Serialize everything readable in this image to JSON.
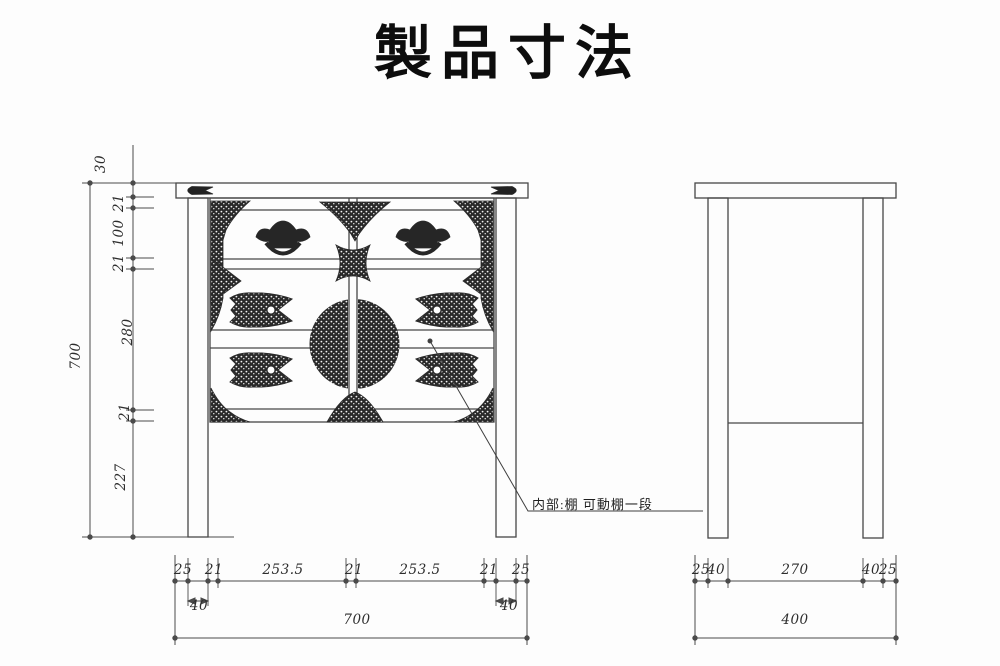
{
  "title": "製品寸法",
  "annotation": {
    "text": "内部:棚  可動棚一段"
  },
  "dimensions": {
    "front_view": {
      "height_chain_mm": [
        "30",
        "21",
        "100",
        "21",
        "280",
        "21",
        "227"
      ],
      "height_total_mm": "700",
      "width_chain_mm": [
        "25",
        "21",
        "253.5",
        "21",
        "253.5",
        "21",
        "25"
      ],
      "leg_width_mm": [
        "40",
        "40"
      ],
      "width_total_mm": "700"
    },
    "side_view": {
      "depth_chain_mm": [
        "25",
        "40",
        "270",
        "40",
        "25"
      ],
      "depth_total_mm": "400"
    }
  },
  "dimension_labels": [
    {
      "text": "30",
      "x": 101,
      "y": 164,
      "rot": -90
    },
    {
      "text": "21",
      "x": 119,
      "y": 203,
      "rot": -90
    },
    {
      "text": "100",
      "x": 119,
      "y": 233,
      "rot": -90
    },
    {
      "text": "21",
      "x": 119,
      "y": 263,
      "rot": -90
    },
    {
      "text": "280",
      "x": 128,
      "y": 332,
      "rot": -90
    },
    {
      "text": "21",
      "x": 125,
      "y": 412,
      "rot": -90
    },
    {
      "text": "227",
      "x": 121,
      "y": 477,
      "rot": -90
    },
    {
      "text": "700",
      "x": 76,
      "y": 356,
      "rot": -90
    },
    {
      "text": "25",
      "x": 183,
      "y": 570,
      "rot": 0
    },
    {
      "text": "21",
      "x": 214,
      "y": 570,
      "rot": 0
    },
    {
      "text": "253.5",
      "x": 283,
      "y": 570,
      "rot": 0
    },
    {
      "text": "21",
      "x": 354,
      "y": 570,
      "rot": 0
    },
    {
      "text": "253.5",
      "x": 420,
      "y": 570,
      "rot": 0
    },
    {
      "text": "21",
      "x": 489,
      "y": 570,
      "rot": 0
    },
    {
      "text": "25",
      "x": 521,
      "y": 570,
      "rot": 0
    },
    {
      "text": "40",
      "x": 199,
      "y": 606,
      "rot": 0
    },
    {
      "text": "40",
      "x": 509,
      "y": 606,
      "rot": 0
    },
    {
      "text": "700",
      "x": 357,
      "y": 620,
      "rot": 0
    },
    {
      "text": "25",
      "x": 701,
      "y": 570,
      "rot": 0
    },
    {
      "text": "40",
      "x": 716,
      "y": 570,
      "rot": 0
    },
    {
      "text": "270",
      "x": 795,
      "y": 570,
      "rot": 0
    },
    {
      "text": "40",
      "x": 871,
      "y": 570,
      "rot": 0
    },
    {
      "text": "25",
      "x": 888,
      "y": 570,
      "rot": 0
    },
    {
      "text": "400",
      "x": 795,
      "y": 620,
      "rot": 0
    }
  ],
  "colors": {
    "ink": "#474747",
    "dimension_line": "#4a4a4a",
    "hardware": "#262626",
    "background": "#fdfdfd",
    "title_color": "#0d0d0d"
  }
}
